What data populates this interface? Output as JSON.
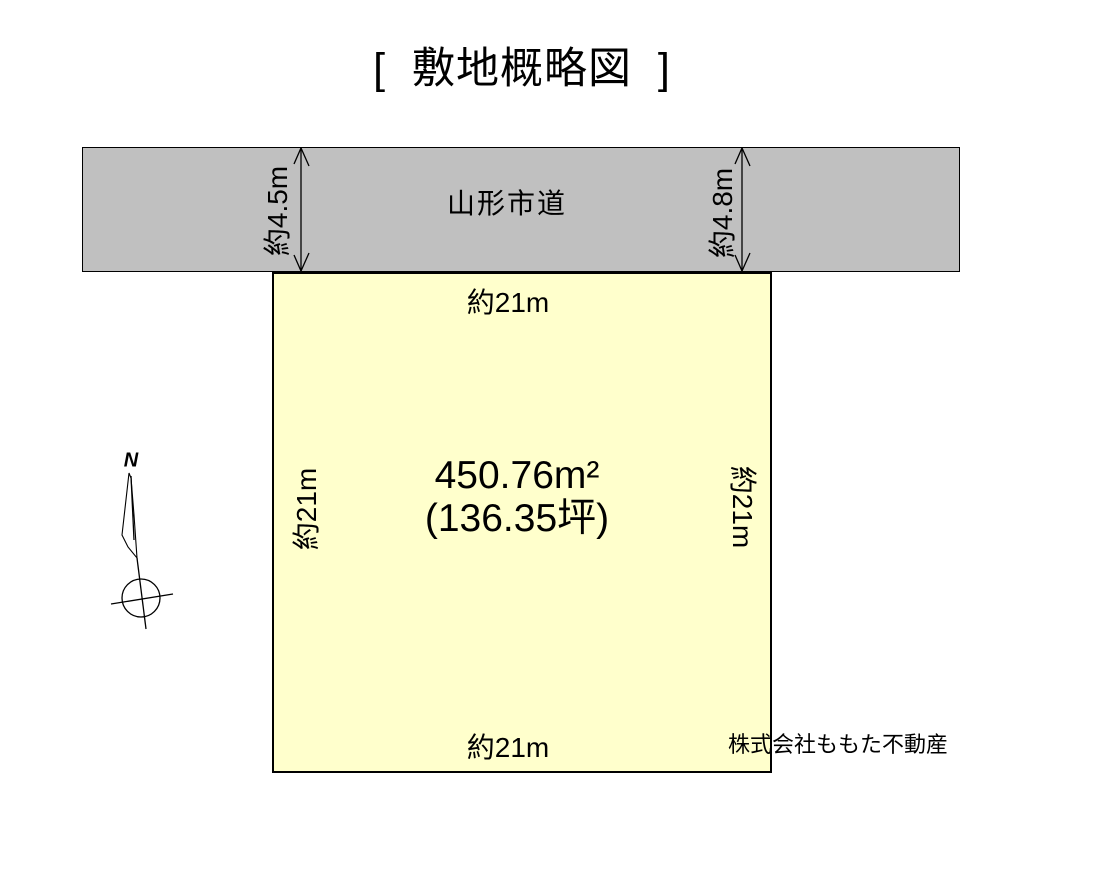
{
  "title": "[  敷地概略図  ]",
  "road": {
    "label": "山形市道",
    "left_width": "約4.5m",
    "right_width": "約4.8m"
  },
  "plot": {
    "area_m2": "450.76m²",
    "area_tsubo": "(136.35坪)",
    "top_dim": "約21m",
    "bottom_dim": "約21m",
    "left_dim": "約21m",
    "right_dim": "約21m"
  },
  "compass": {
    "north_label": "N"
  },
  "company": "株式会社ももた不動産",
  "colors": {
    "road_fill": "#c0c0c0",
    "plot_fill": "#ffffcc",
    "line": "#000000",
    "background": "#ffffff"
  }
}
